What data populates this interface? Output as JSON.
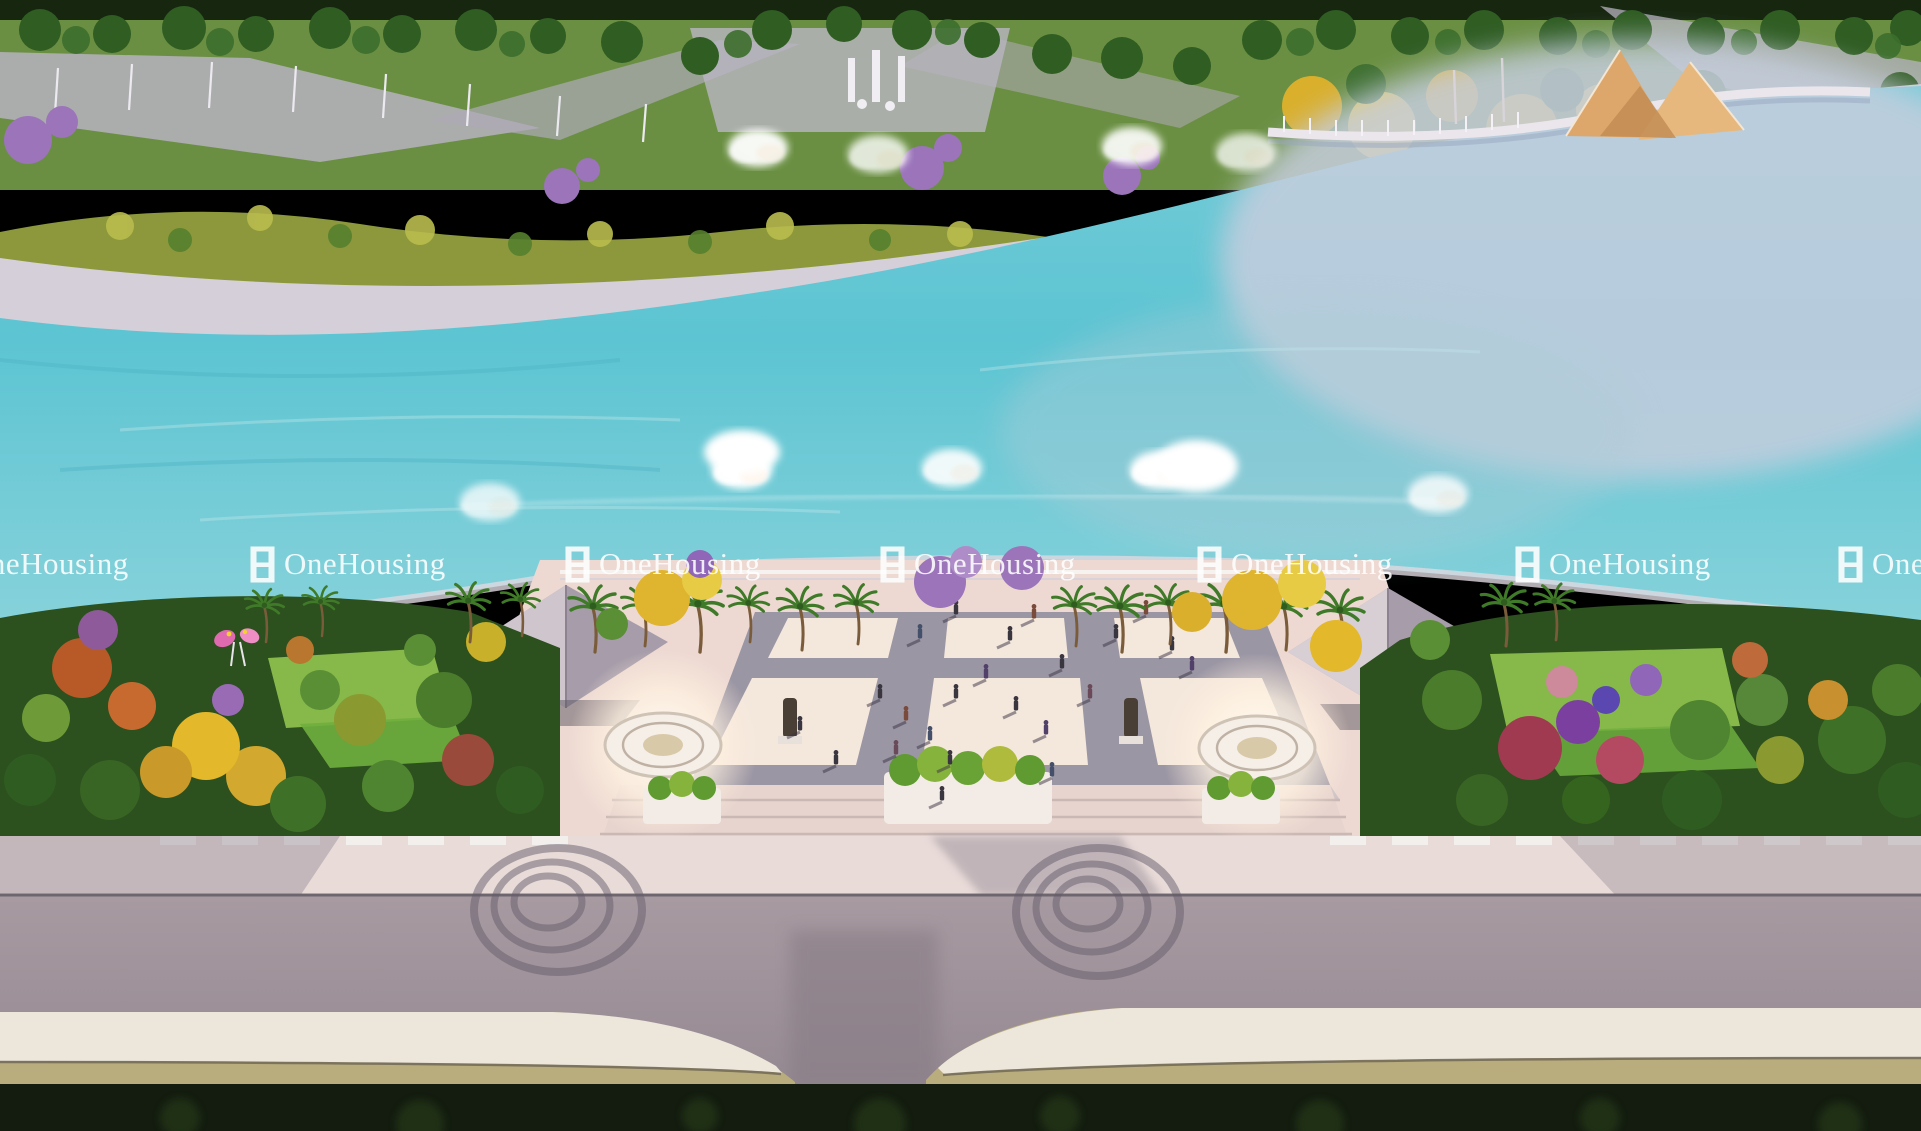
{
  "brand_watermark": {
    "text": "OneHousing",
    "logo": "onehousing-window-logo",
    "color": "#ffffff",
    "opacity": 0.88,
    "row_top": 546,
    "positions_x": [
      -67,
      250,
      565,
      880,
      1197,
      1515,
      1838
    ]
  },
  "palette": {
    "water": "#5fc6d4",
    "water_light": "#8fd6dd",
    "water_pale": "#c6cede",
    "shore_sand": "#d5cfd9",
    "park_green": "#6a8f42",
    "tree_green_dark": "#2f5d22",
    "tree_yellow": "#dfb42e",
    "tree_purple": "#9b74ba",
    "path_gray": "#b6b2be",
    "plaza_paving": "#edd9d2",
    "tile_light": "#f4e7dc",
    "tile_frame": "#9b96a4",
    "lawn_green": "#86b84a",
    "garden_dark_green": "#2c501e",
    "pavilion_roof": "#a79daa",
    "pavilion_roof_light": "#cfc5cc",
    "road_gray": "#9e929b",
    "sidewalk_pink": "#e9dbd8",
    "slab_cream": "#ece6db",
    "slab_fascia_khaki": "#b9ad7e",
    "bottom_dark": "#141c10",
    "fountain_glow": "#fff8ec",
    "sail_tan": "#dda76b",
    "watermark_white": "#ffffff"
  }
}
